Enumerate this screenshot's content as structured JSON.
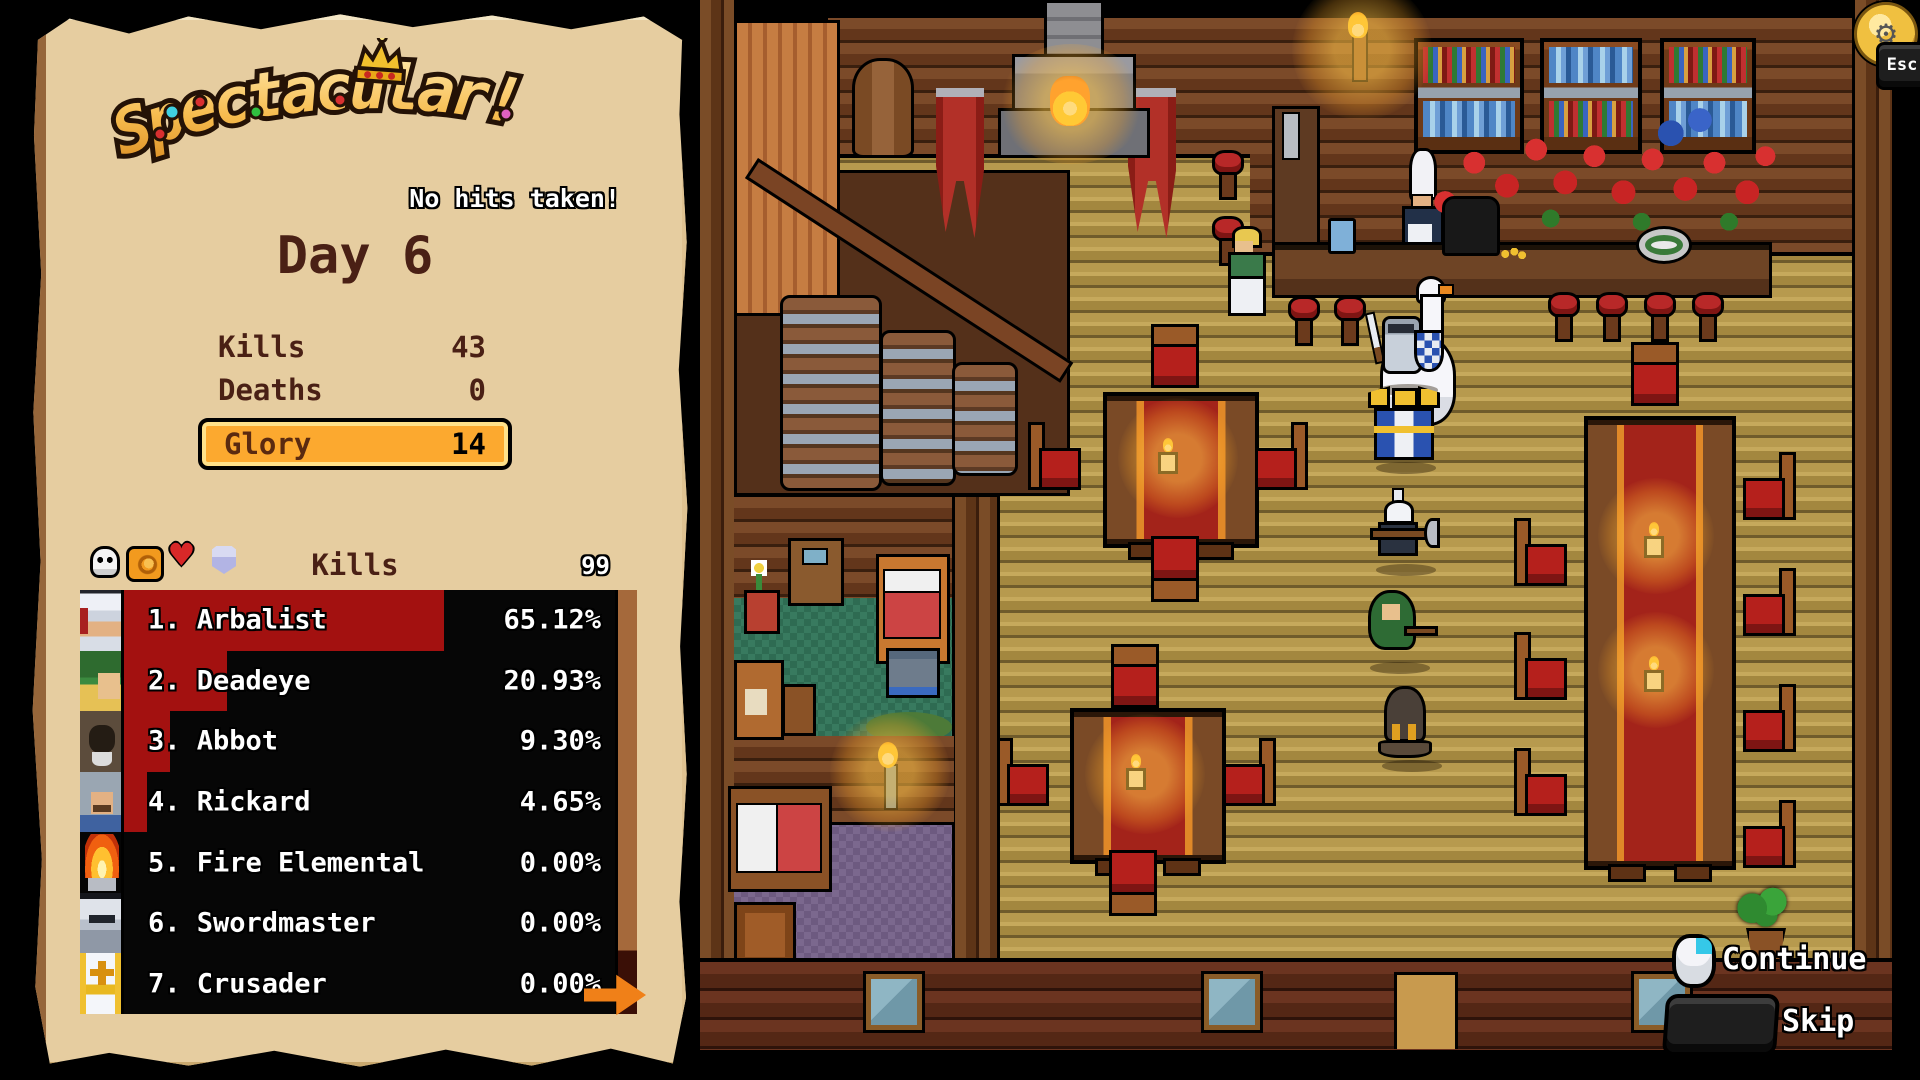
{
  "results_panel": {
    "logo": {
      "title": "Spectacular!",
      "subtitle": "No hits taken!"
    },
    "day_title": "Day 6",
    "stats": [
      {
        "label": "Kills",
        "value": "43"
      },
      {
        "label": "Deaths",
        "value": "0"
      }
    ],
    "glory": {
      "label": "Glory",
      "value": "14"
    },
    "leaderboard": {
      "sort_header": "Kills",
      "scale_max": "99",
      "header_icons": [
        "skull-icon",
        "fist-icon",
        "heart-icon",
        "shield-icon"
      ],
      "rows": [
        {
          "rank": "1.",
          "name": "Arbalist",
          "percent": "65.12%",
          "percent_value": 65.12,
          "portrait": "arbalist"
        },
        {
          "rank": "2.",
          "name": "Deadeye",
          "percent": "20.93%",
          "percent_value": 20.93,
          "portrait": "deadeye"
        },
        {
          "rank": "3.",
          "name": "Abbot",
          "percent": "9.30%",
          "percent_value": 9.3,
          "portrait": "abbot"
        },
        {
          "rank": "4.",
          "name": "Rickard",
          "percent": "4.65%",
          "percent_value": 4.65,
          "portrait": "rickard"
        },
        {
          "rank": "5.",
          "name": "Fire Elemental",
          "percent": "0.00%",
          "percent_value": 0,
          "portrait": "fire"
        },
        {
          "rank": "6.",
          "name": "Swordmaster",
          "percent": "0.00%",
          "percent_value": 0,
          "portrait": "swordmaster"
        },
        {
          "rank": "7.",
          "name": "Crusader",
          "percent": "0.00%",
          "percent_value": 0,
          "portrait": "crusader"
        }
      ]
    }
  },
  "hud": {
    "continue_label": "Continue",
    "skip_label": "Skip",
    "esc_label": "Esc"
  },
  "colors": {
    "parchment": "#e6cda0",
    "glory_orange": "#fca92f",
    "leaderboard_red": "#a31110",
    "day_text": "#4a2015",
    "scene_floor": "#b79a4e"
  }
}
